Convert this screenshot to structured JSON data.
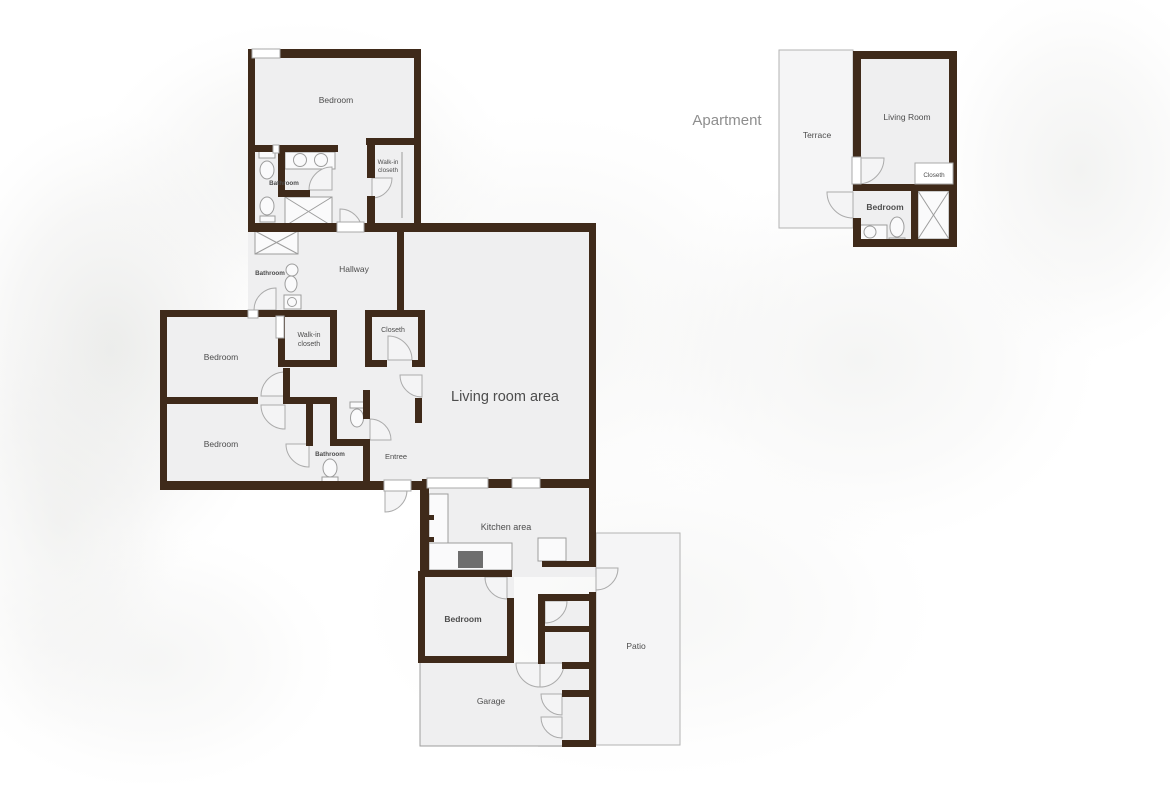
{
  "page": {
    "background_color": "#ffffff"
  },
  "colors": {
    "wall": "#3f2a1a",
    "room_fill": "#efeff0",
    "patio_fill": "#f3f3f4",
    "outline": "#ababab",
    "label": "#4d4d4d",
    "apartment_label": "#8e8e8e",
    "stove": "#6e6e6e"
  },
  "main_house": {
    "bedroom_top": "Bedroom",
    "bathroom_main": "Bathroom",
    "walk_in_top_line1": "Walk-in",
    "walk_in_top_line2": "closeth",
    "bathroom_small": "Bathroom",
    "hallway": "Hallway",
    "walk_in_mid_line1": "Walk-in",
    "walk_in_mid_line2": "closeth",
    "closet_hall": "Closeth",
    "bedroom_left_upper": "Bedroom",
    "bedroom_left_lower": "Bedroom",
    "bathroom_entree": "Bathroom",
    "entree": "Entree",
    "living_room": "Living room area",
    "kitchen": "Kitchen area",
    "bedroom_bottom": "Bedroom",
    "garage": "Garage",
    "patio": "Patio"
  },
  "apartment": {
    "title": "Apartment",
    "terrace": "Terrace",
    "living_room": "Living Room",
    "closet": "Closeth",
    "bedroom": "Bedroom"
  }
}
